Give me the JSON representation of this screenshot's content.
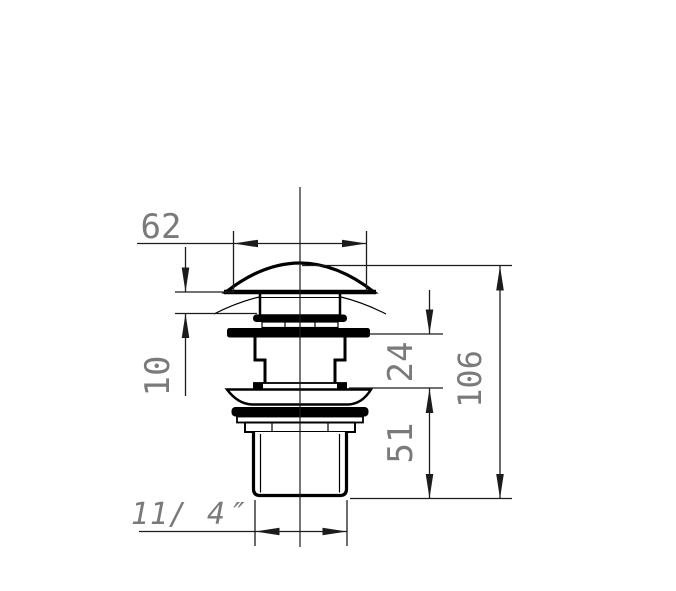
{
  "drawing": {
    "kind": "technical-dimension-drawing",
    "dimension_labels": {
      "cap_width": "62",
      "cap_edge_height": "10",
      "neck_height": "24",
      "thread_length": "51",
      "overall_height": "106",
      "thread_size": "11/ 4″"
    },
    "colors": {
      "line": "#000000",
      "dimension_text": "#7a7a7a",
      "background": "#ffffff"
    }
  }
}
